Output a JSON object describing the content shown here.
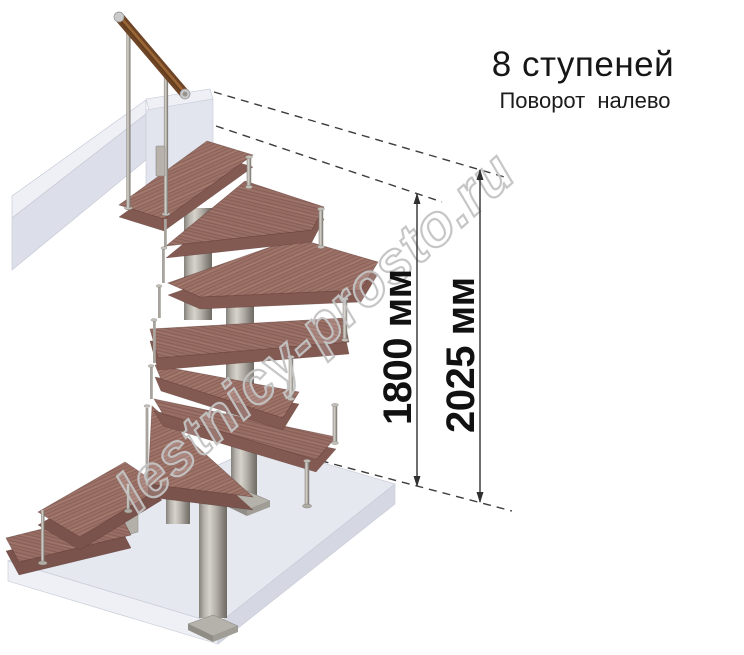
{
  "header": {
    "title": "8 ступеней",
    "subtitle": "Поворот налево"
  },
  "dimensions": {
    "inner": {
      "label": "1800 мм",
      "value": 1800,
      "unit": "мм"
    },
    "outer": {
      "label": "2025 мм",
      "value": 2025,
      "unit": "мм"
    }
  },
  "watermark": {
    "text": "lestnicy-prosto.ru"
  },
  "illustration": {
    "subject": "modular spiral staircase 3D render",
    "steps_count": 8,
    "turn_direction": "left",
    "colors": {
      "tread_wood": "#9c7167",
      "tread_edge": "#835a52",
      "metal": "#a8a49d",
      "floor_slab": "#e6e8f0",
      "upper_beam": "#e9ebf1",
      "handrail_wood": "#6d4426",
      "annotation": "#303030",
      "watermark_gray": "#c4c4c4"
    }
  }
}
